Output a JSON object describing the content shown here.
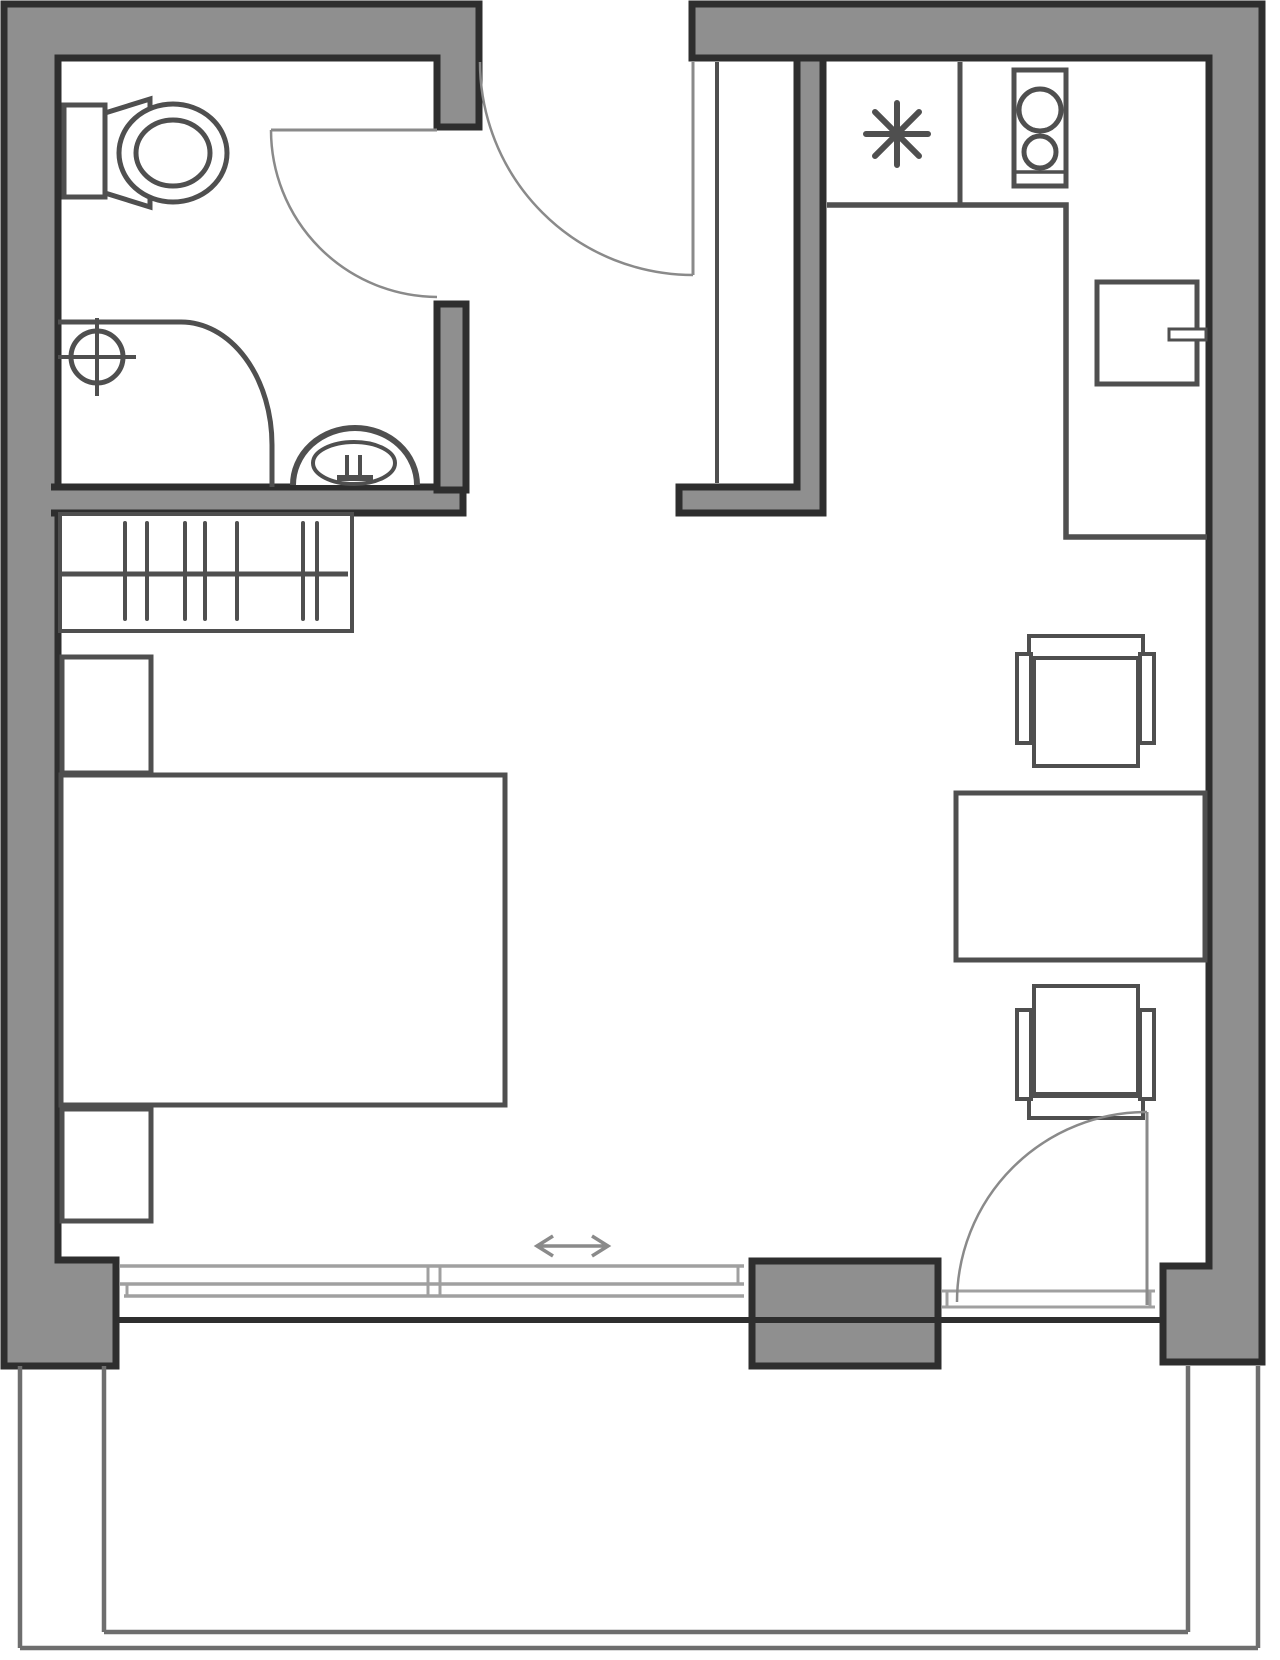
{
  "document": {
    "kind": "architectural floor plan",
    "description": "Black-and-white studio apartment floor plan with balcony; no text labels visible",
    "canvas": {
      "width": 1280,
      "height": 1660,
      "background": "#ffffff"
    }
  },
  "colors": {
    "bg": "#ffffff",
    "wall_fill": "#8f8f8f",
    "wall_outline": "#2e2e2e",
    "fixture_stroke": "#4f4f4f",
    "door_stroke": "#8a8a8a",
    "glass_stroke": "#a0a0a0",
    "railing_stroke": "#6e6e6e"
  },
  "rooms": [
    {
      "name": "bathroom",
      "position": "top-left"
    },
    {
      "name": "entrance-hall",
      "position": "top-center"
    },
    {
      "name": "kitchen",
      "position": "top-right"
    },
    {
      "name": "living-sleeping-area",
      "position": "center"
    },
    {
      "name": "balcony",
      "position": "bottom"
    }
  ],
  "fixtures": [
    "toilet-with-cistern",
    "corner-shower-with-drain",
    "washbasin-with-tap",
    "wardrobe-with-hanging-rail",
    "nightstand-head",
    "double-bed",
    "nightstand-foot",
    "kitchen-sink-symbol",
    "two-ring-hob",
    "under-counter-fridge-with-handle",
    "l-shaped-kitchen-counter",
    "dining-table",
    "chair-north",
    "chair-south"
  ],
  "openings": [
    "entrance-door-swing",
    "bathroom-door-swing",
    "balcony-hinged-door",
    "sliding-window-with-direction-arrow"
  ],
  "symbols": {
    "sink": "asterisk-8-point",
    "slide_direction": "double-headed-arrow",
    "shower_drain": "crosshair-circle"
  }
}
